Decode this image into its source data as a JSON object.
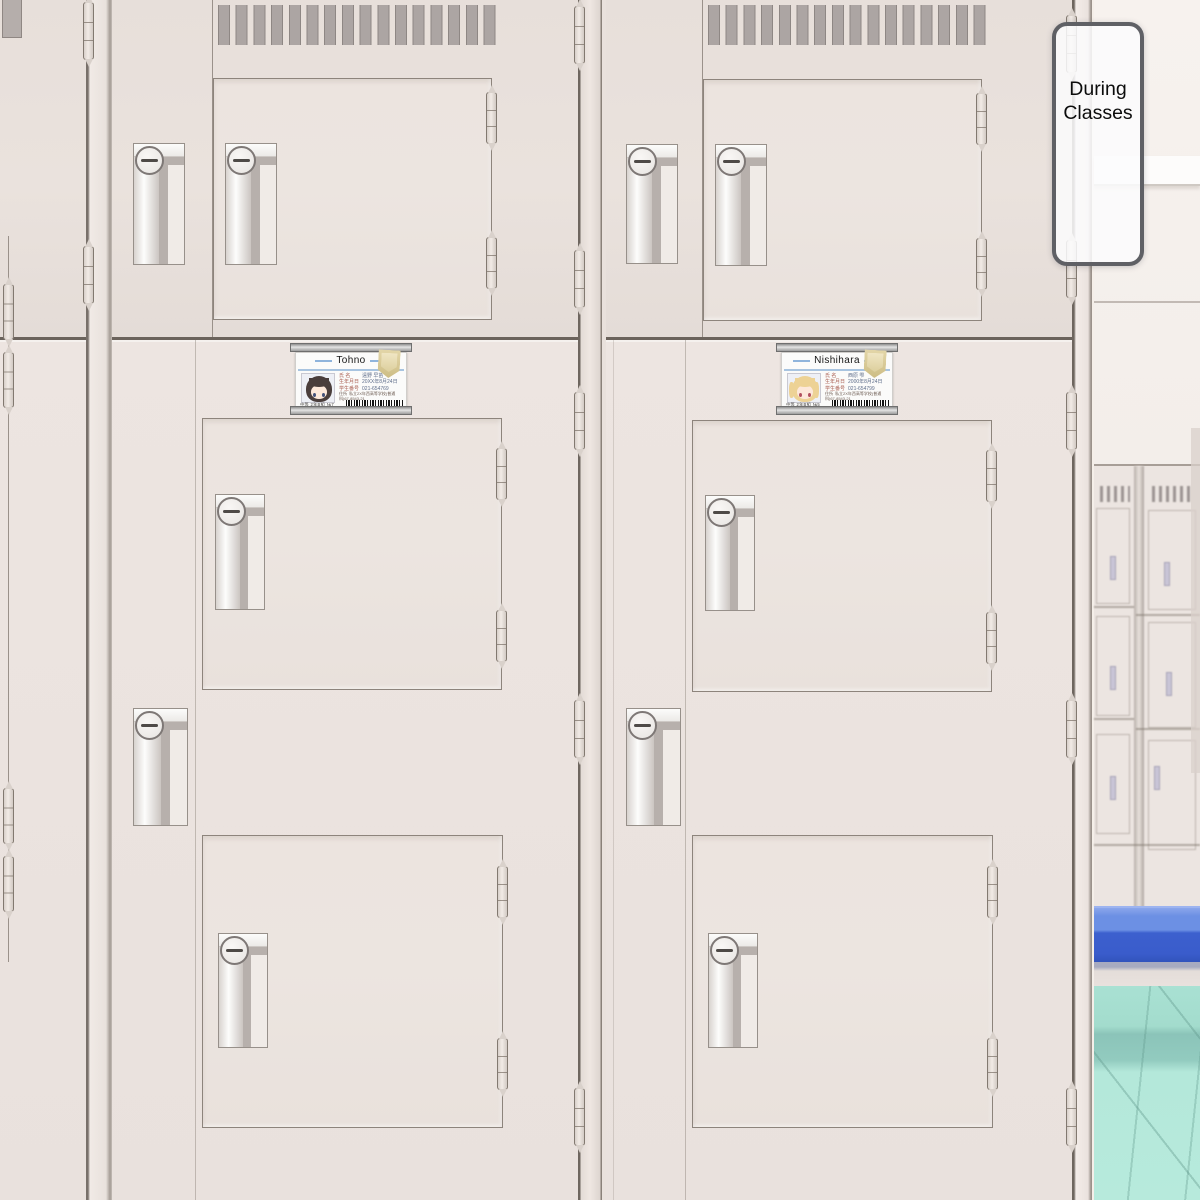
{
  "sign": {
    "line1": "During",
    "line2": "Classes"
  },
  "cards": [
    {
      "name": "Tohno",
      "fields": [
        {
          "label": "氏 名",
          "value": "遠野 早苗"
        },
        {
          "label": "生年月日",
          "value": "20XX年8月24日"
        },
        {
          "label": "学生番号",
          "value": "021-654769"
        }
      ],
      "address_label": "住所",
      "address": "私立2X年西高等学校(普通科)67-8543-21",
      "footer": "中等 2年B組 №7"
    },
    {
      "name": "Nishihara",
      "fields": [
        {
          "label": "氏 名",
          "value": "西原 雫"
        },
        {
          "label": "生年月日",
          "value": "2000年8月24日"
        },
        {
          "label": "学生番号",
          "value": "021-654799"
        }
      ],
      "address_label": "住所",
      "address": "私立2X年西高等学校(普通科)67-8543-21",
      "footer": "中等 2年B組 №5"
    }
  ],
  "colors": {
    "locker_face": "#eae2dd",
    "bench_blue": "#3a5ccb",
    "bench_blue_light": "#6c90e4",
    "floor_teal": "#aee3d5",
    "card_accent_blue": "#8fb4dc",
    "emblem_gold": "#d6c68f"
  }
}
